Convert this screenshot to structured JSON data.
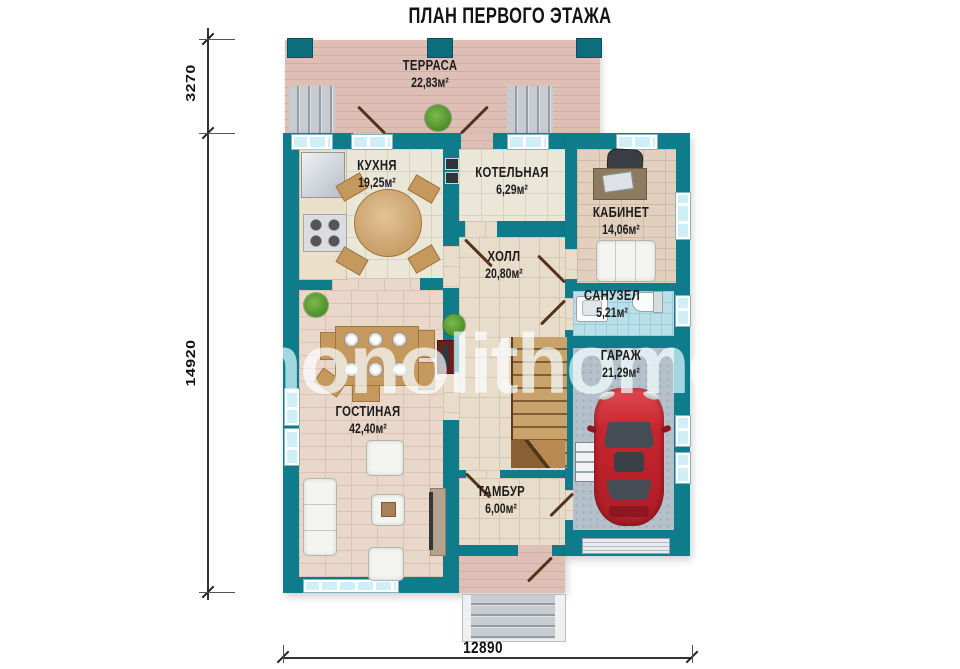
{
  "title": "ПЛАН ПЕРВОГО ЭТАЖА",
  "watermark": "monolithome",
  "rooms": [
    {
      "id": "terrace",
      "name": "ТЕРРАСА",
      "area": "22,83м²"
    },
    {
      "id": "kitchen",
      "name": "КУХНЯ",
      "area": "19,25м²"
    },
    {
      "id": "boiler",
      "name": "КОТЕЛЬНАЯ",
      "area": "6,29м²"
    },
    {
      "id": "office",
      "name": "КАБИНЕТ",
      "area": "14,06м²"
    },
    {
      "id": "hall",
      "name": "ХОЛЛ",
      "area": "20,80м²"
    },
    {
      "id": "bathroom",
      "name": "САНУЗЕЛ",
      "area": "5,21м²"
    },
    {
      "id": "garage",
      "name": "ГАРАЖ",
      "area": "21,29м²"
    },
    {
      "id": "living",
      "name": "ГОСТИНАЯ",
      "area": "42,40м²"
    },
    {
      "id": "vestibule",
      "name": "ТАМБУР",
      "area": "6,00м²"
    }
  ],
  "dimensions": {
    "left_top": "3270",
    "left_total": "14920",
    "bottom_total": "12890"
  },
  "colors": {
    "wall": "#0e7c8b",
    "car": "#c7252f",
    "deck": "#debfb5",
    "bath_tile": "#b9dfe9",
    "stair_wood": "#c9a26c"
  }
}
